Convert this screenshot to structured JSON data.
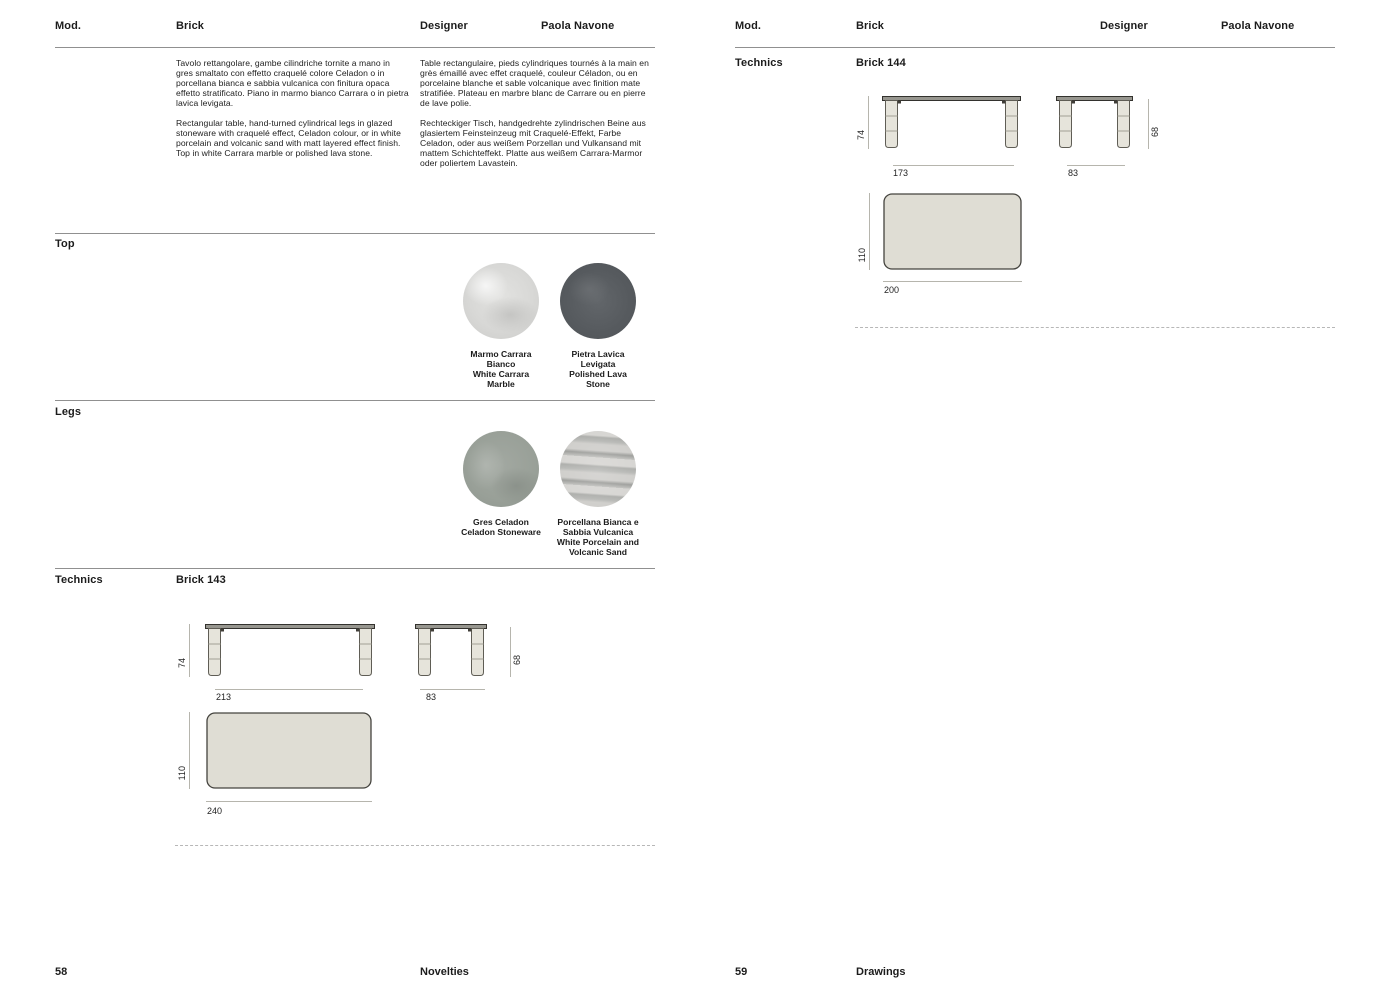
{
  "colors": {
    "text": "#1c1c1c",
    "rule": "#909090",
    "marble_swatch": "#d8d8d6",
    "lava_swatch": "#565a5e",
    "celadon_swatch": "#99a098",
    "porcelain_swatch": "#c3c3c0",
    "drawing_fill": "#dfddd4"
  },
  "left_page": {
    "header": {
      "mod_label": "Mod.",
      "model": "Brick",
      "designer_label": "Designer",
      "designer_name": "Paola Navone"
    },
    "description": {
      "italian": "Tavolo rettangolare, gambe cilindriche tornite a mano in gres smaltato con effetto craquelé colore Celadon o in porcellana bianca e sabbia vulcanica con finitura opaca effetto stratificato. Piano in marmo bianco Carrara o in pietra lavica levigata.",
      "english": "Rectangular table, hand-turned cylindrical legs in glazed stoneware with craquelé effect, Celadon colour, or in white porcelain and volcanic sand with matt layered effect finish. Top in white Carrara marble or polished lava stone.",
      "french": "Table rectangulaire, pieds cylindriques tournés à la main en grès émaillé avec effet craquelé, couleur Céladon, ou en porcelaine blanche et sable volcanique avec finition mate stratifiée. Plateau en marbre blanc de Carrare ou en pierre de lave polie.",
      "german": "Rechteckiger Tisch, handgedrehte zylindrischen Beine aus glasiertem Feinsteinzeug mit Craquelé-Effekt, Farbe Celadon, oder aus weißem Porzellan und Vulkansand mit mattem Schichteffekt. Platte aus weißem Carrara-Marmor oder poliertem Lavastein."
    },
    "top_section": {
      "label": "Top",
      "swatches": [
        {
          "lines": [
            "Marmo Carrara",
            "Bianco",
            "White Carrara",
            "Marble"
          ]
        },
        {
          "lines": [
            "Pietra Lavica",
            "Levigata",
            "Polished Lava",
            "Stone"
          ]
        }
      ]
    },
    "legs_section": {
      "label": "Legs",
      "swatches": [
        {
          "lines": [
            "Gres Celadon",
            "Celadon Stoneware"
          ]
        },
        {
          "lines": [
            "Porcellana Bianca e",
            "Sabbia Vulcanica",
            "White Porcelain and",
            "Volcanic Sand"
          ]
        }
      ]
    },
    "technics": {
      "label": "Technics",
      "model": "Brick 143",
      "front_height": "74",
      "front_width": "213",
      "side_width": "83",
      "side_height": "68",
      "plan_depth": "110",
      "plan_width": "240"
    },
    "footer": {
      "page_number": "58",
      "section_label": "Novelties"
    }
  },
  "right_page": {
    "header": {
      "mod_label": "Mod.",
      "model": "Brick",
      "designer_label": "Designer",
      "designer_name": "Paola Navone"
    },
    "technics": {
      "label": "Technics",
      "model": "Brick 144",
      "front_height": "74",
      "front_width": "173",
      "side_width": "83",
      "side_height": "68",
      "plan_depth": "110",
      "plan_width": "200"
    },
    "footer": {
      "page_number": "59",
      "section_label": "Drawings"
    }
  }
}
